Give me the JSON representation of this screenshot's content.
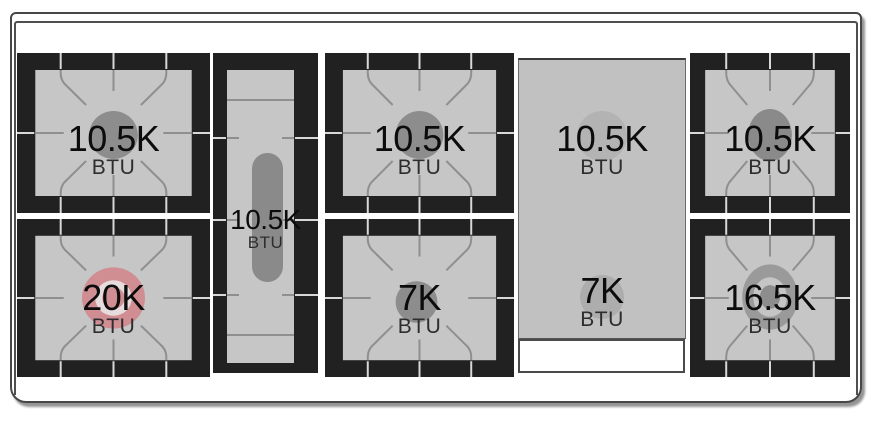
{
  "cooktop": {
    "burners": [
      {
        "id": "top-left",
        "value": "10.5K",
        "unit": "BTU"
      },
      {
        "id": "bottom-left",
        "value": "20K",
        "unit": "BTU",
        "highlighted": true
      },
      {
        "id": "center-oval",
        "value": "10.5K",
        "unit": "BTU"
      },
      {
        "id": "top-middle",
        "value": "10.5K",
        "unit": "BTU"
      },
      {
        "id": "bottom-middle",
        "value": "7K",
        "unit": "BTU"
      },
      {
        "id": "griddle-top",
        "value": "10.5K",
        "unit": "BTU"
      },
      {
        "id": "griddle-bottom",
        "value": "7K",
        "unit": "BTU"
      },
      {
        "id": "top-right",
        "value": "10.5K",
        "unit": "BTU"
      },
      {
        "id": "bottom-right",
        "value": "16.5K",
        "unit": "BTU"
      }
    ],
    "colors": {
      "highlight_burner": "#d08d92",
      "highlight_ring": "#e7dcdd",
      "burner_circle_gray": "#8d8d8d",
      "surface_gray": "#c6c6c6",
      "griddle_gray": "#c1c1c1",
      "grate_frame_black": "#212121"
    }
  }
}
